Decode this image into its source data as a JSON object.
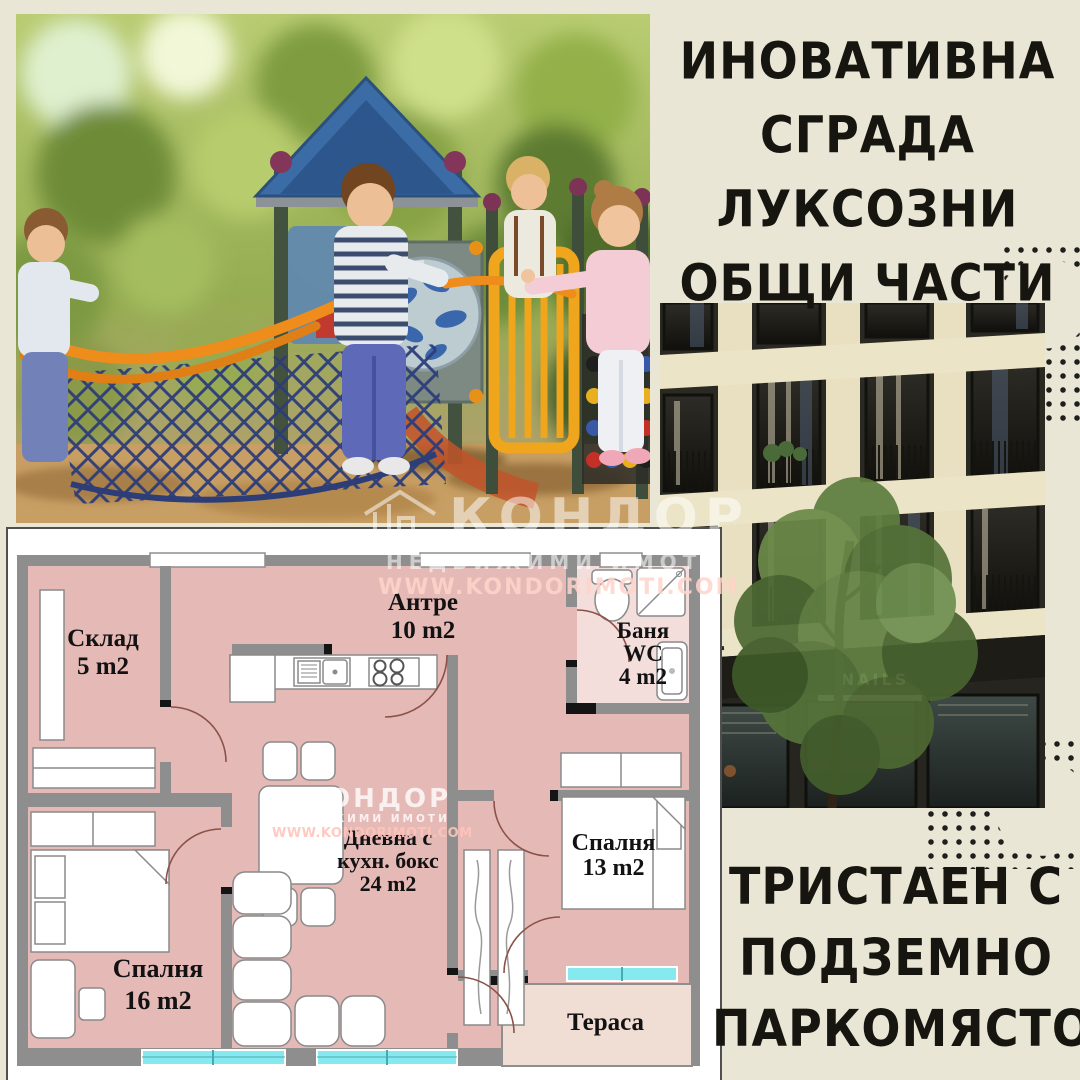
{
  "headline_top": {
    "lines": [
      "ИНОВАТИВНА",
      "СГРАДА",
      "ЛУКСОЗНИ",
      "ОБЩИ ЧАСТИ"
    ]
  },
  "headline_bottom": {
    "lines": [
      "ТРИСТАЕН С",
      "ПОДЗЕМНО",
      "ПАРКОМЯСТО"
    ]
  },
  "watermark": {
    "brand": "КОНДОР",
    "tagline": "НЕДВИЖИМИ ИМОТИ",
    "url": "WWW.KONDORIMOTI.COM"
  },
  "building_photo": {
    "storefront_sign": "NAILS"
  },
  "floor_plan": {
    "rooms": [
      {
        "id": "storage",
        "name": "Склад",
        "area": "5 m2"
      },
      {
        "id": "hallway",
        "name": "Антре",
        "area": "10 m2"
      },
      {
        "id": "bathroom",
        "name": "Баня",
        "name2": "WC",
        "area": "4 m2"
      },
      {
        "id": "living",
        "name": "Дневна с",
        "name2": "кухн. бокс",
        "area": "24 m2"
      },
      {
        "id": "bedroom1",
        "name": "Спалня",
        "area": "16 m2"
      },
      {
        "id": "bedroom2",
        "name": "Спалня",
        "area": "13 m2"
      },
      {
        "id": "terrace",
        "name": "Тераса",
        "area": ""
      }
    ]
  },
  "palette": {
    "background": "#e9e6d5",
    "headline_text": "#17150f",
    "plan_room_pink": "#e5b9b6",
    "plan_bathroom_pink": "#f3dedb",
    "plan_terrace": "#f0ddd4",
    "plan_wall_gray": "#8e8e8e",
    "plan_window_cyan": "#86e9ef",
    "dots": "#1e1e1c",
    "watermark": "#ffffff"
  }
}
